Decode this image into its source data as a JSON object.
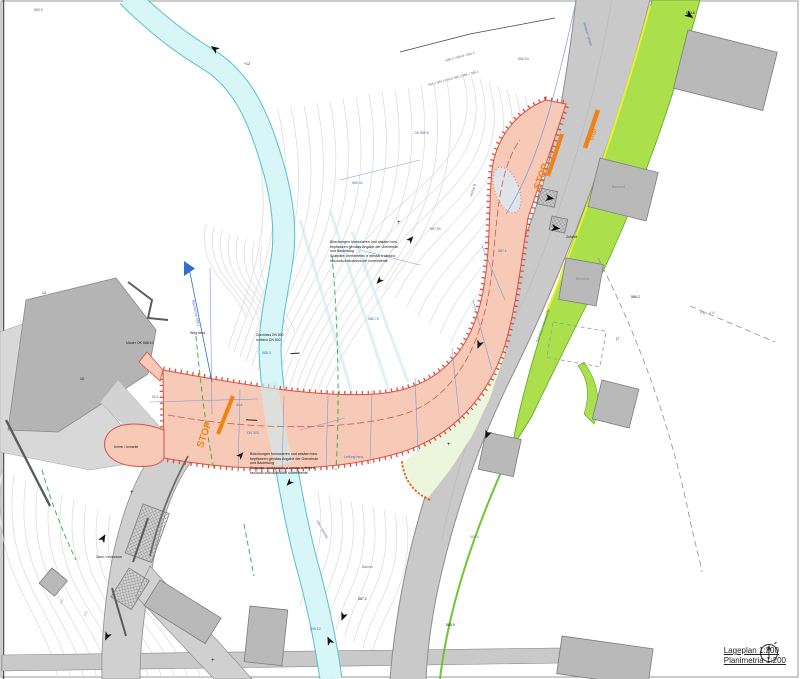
{
  "title_block": {
    "scale_label_de": "Lageplan 1:200",
    "scale_label_it": "Planimetria 1:200"
  },
  "notes": {
    "upper": {
      "x": 330,
      "y": 240,
      "lines": [
        "Böschungen humusieren und ansäen bzw.",
        "bepflanzen gemäss Angabe der Gemeinde",
        "und Bauleitung",
        "Scarpate: inerbimento e messa a dimora",
        "secondo indicazioni del committente"
      ]
    },
    "lower": {
      "x": 250,
      "y": 452,
      "lines": [
        "Böschungen humusieren und ansäen bzw.",
        "bepflanzen gemäss Angabe der Gemeinde",
        "und Bauleitung",
        "Scarpate: inerbimento e messa a dimora",
        "secondo indicazioni del committente"
      ]
    }
  },
  "labels": [
    {
      "t": "STOP",
      "x": 196,
      "y": 446,
      "s": 10,
      "c": "#f08316",
      "r": -70,
      "b": 1
    },
    {
      "t": "STOP",
      "x": 533,
      "y": 188,
      "s": 10,
      "c": "#f08316",
      "r": -70,
      "b": 1
    },
    {
      "t": "STOP",
      "x": 590,
      "y": 140,
      "s": 4.5,
      "c": "#f08316",
      "r": -70,
      "b": 1
    },
    {
      "t": "SLA",
      "x": 152,
      "y": 396,
      "s": 3.5,
      "c": "#4a6fc0"
    },
    {
      "t": "SLA",
      "x": 236,
      "y": 404,
      "s": 3.5,
      "c": "#4a6fc0"
    },
    {
      "t": "DN 300",
      "x": 247,
      "y": 432,
      "s": 3.5,
      "c": "#4a6fc0"
    },
    {
      "t": "589.42",
      "x": 352,
      "y": 182,
      "s": 3.5,
      "c": "#4a6fc0"
    },
    {
      "t": "588.76",
      "x": 368,
      "y": 318,
      "s": 3.5,
      "c": "#4a6fc0"
    },
    {
      "t": "Achse B",
      "x": 470,
      "y": 196,
      "s": 3.5,
      "c": "#4a6fc0",
      "r": -70
    },
    {
      "t": "587.90",
      "x": 430,
      "y": 228,
      "s": 3.5,
      "c": "#4a6fc0"
    },
    {
      "t": "586.54",
      "x": 518,
      "y": 58,
      "s": 3.5,
      "c": "#4a6fc0"
    },
    {
      "t": "Leitung best.",
      "x": 344,
      "y": 456,
      "s": 3.5,
      "c": "#4a6fc0"
    },
    {
      "t": "590.12",
      "x": 310,
      "y": 628,
      "s": 3.5,
      "c": "#4a6fc0"
    },
    {
      "t": "Bacino",
      "x": 362,
      "y": 566,
      "s": 3.5,
      "c": "#4a6fc0"
    },
    {
      "t": "Strasse / strada",
      "x": 585,
      "y": 22,
      "s": 3.5,
      "c": "#4a6fc0",
      "r": 73
    },
    {
      "t": "Bachachse 589.1",
      "x": 194,
      "y": 300,
      "s": 3.5,
      "c": "#4a6fc0",
      "r": 78
    },
    {
      "t": "588.3",
      "x": 262,
      "y": 352,
      "s": 3.5,
      "c": "#4a6fc0"
    },
    {
      "t": "OK 589.5",
      "x": 414,
      "y": 132,
      "s": 3.5,
      "c": "#4a6fc0"
    },
    {
      "t": "587.1",
      "x": 498,
      "y": 250,
      "s": 3.5,
      "c": "#4a6fc0"
    },
    {
      "t": "Mauer OK 588.10",
      "x": 126,
      "y": 342,
      "s": 3.5
    },
    {
      "t": "Weg best.",
      "x": 190,
      "y": 332,
      "s": 3.5
    },
    {
      "t": "Bestand",
      "x": 612,
      "y": 186,
      "s": 3.5,
      "c": "#8a8a8a"
    },
    {
      "t": "Bestand",
      "x": 576,
      "y": 278,
      "s": 3.5,
      "c": "#8a8a8a"
    },
    {
      "t": "Zufahrt",
      "x": 566,
      "y": 236,
      "s": 3.5
    },
    {
      "t": "584.6",
      "x": 686,
      "y": 12,
      "s": 3.5
    },
    {
      "t": "586.2",
      "x": 631,
      "y": 296,
      "s": 3.5
    },
    {
      "t": "Parz. 410",
      "x": 700,
      "y": 312,
      "s": 3.5,
      "c": "#8a8a8a"
    },
    {
      "t": "592",
      "x": 84,
      "y": 616,
      "s": 3.5,
      "c": "#b0b0b0",
      "r": -72
    },
    {
      "t": "590",
      "x": 60,
      "y": 604,
      "s": 3.5,
      "c": "#b0b0b0",
      "r": -72
    },
    {
      "t": "+",
      "x": 130,
      "y": 490,
      "s": 6
    },
    {
      "t": "+",
      "x": 447,
      "y": 442,
      "s": 6
    },
    {
      "t": "+",
      "x": 211,
      "y": 658,
      "s": 6
    },
    {
      "t": "+",
      "x": 397,
      "y": 220,
      "s": 6
    },
    {
      "t": "Durchlass DN 800",
      "x": 256,
      "y": 334,
      "s": 3.4
    },
    {
      "t": "tombino DN 800",
      "x": 256,
      "y": 339,
      "s": 3.4
    },
    {
      "t": "▪▪▪▪▪▪▪▪▪▪▪▪",
      "x": 246,
      "y": 418,
      "s": 4,
      "r": 3,
      "ls": "-0.5px"
    },
    {
      "t": "▪▪▪▪▪▪▪▪▪▪",
      "x": 290,
      "y": 352,
      "s": 4,
      "r": -4,
      "ls": "-0.5px"
    },
    {
      "t": "584.1  584.4  584.8  585.2  585.7  586.1",
      "x": 428,
      "y": 84,
      "s": 3.2,
      "c": "#6b6b6b",
      "r": -15
    },
    {
      "t": "+585.3    +585.8    +586.4",
      "x": 444,
      "y": 60,
      "s": 3.2,
      "c": "#6b6b6b",
      "r": -15
    },
    {
      "t": "Kehre / tornante",
      "x": 114,
      "y": 446,
      "s": 3.4
    },
    {
      "t": "Zaun / recinzione",
      "x": 96,
      "y": 556,
      "s": 3.4
    },
    {
      "t": "587.2",
      "x": 358,
      "y": 598,
      "s": 3.5
    },
    {
      "t": "585.9",
      "x": 446,
      "y": 624,
      "s": 3.5
    },
    {
      "t": "P",
      "x": 616,
      "y": 338,
      "s": 5,
      "c": "#8a8a8a"
    },
    {
      "t": "Gehweg / marciapiede",
      "x": 536,
      "y": 342,
      "s": 3.5,
      "c": "#3f8f1f",
      "r": -70
    },
    {
      "t": "16",
      "x": 80,
      "y": 378,
      "s": 3.5
    },
    {
      "t": "14",
      "x": 42,
      "y": 292,
      "s": 3.5
    },
    {
      "t": "583.9",
      "x": 34,
      "y": 9,
      "s": 3.5,
      "c": "#6b6b6b"
    },
    {
      "t": "+12",
      "x": 244,
      "y": 63,
      "s": 3.5
    },
    {
      "t": "586.8",
      "x": 470,
      "y": 536,
      "s": 3.5,
      "c": "#8a8a8a"
    },
    {
      "t": "Ufer / sponda",
      "x": 318,
      "y": 520,
      "s": 3.4,
      "c": "#4a6fc0",
      "r": 60
    }
  ]
}
